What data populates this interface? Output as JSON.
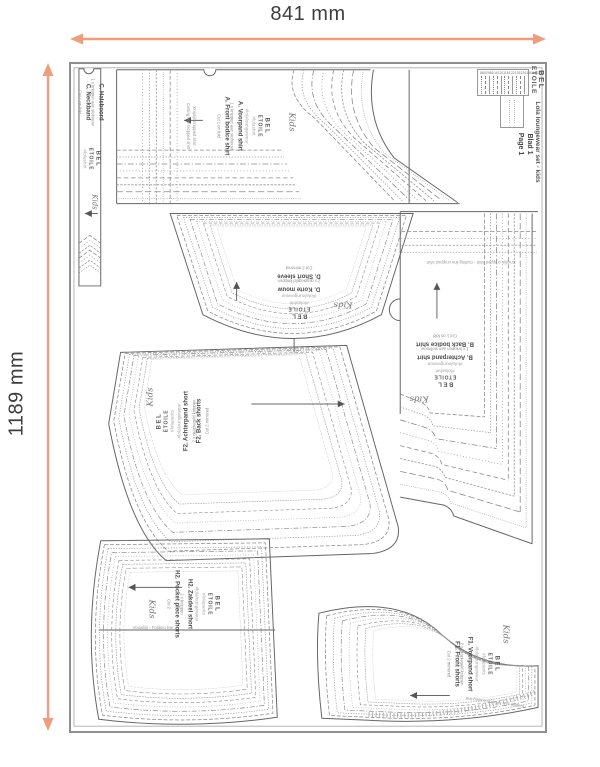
{
  "dimensions": {
    "width_label": "841 mm",
    "height_label": "1189 mm"
  },
  "sheet": {
    "brand_line1": "BEL",
    "brand_line2": "ETOILE",
    "title": "Lola loungewear set - kids",
    "blad": "Blad 1",
    "page": "Page 1",
    "size_legend": {
      "sizes": [
        "86",
        "92",
        "98",
        "104",
        "110",
        "116",
        "122",
        "128",
        "134",
        "140",
        "146",
        "152"
      ]
    }
  },
  "script_logo": "Kids",
  "colors": {
    "accent": "#ef9d7c",
    "line": "#6e6e6e"
  },
  "pieces": {
    "A": {
      "name_nl": "A. Voorpand shirt",
      "cut_nl": "1 x knippen aan stofvouw",
      "name_en": "A. Front bodice shirt",
      "cut_en": "Cut 1 on fold",
      "tag1": "#lolashirt",
      "tag2": "#lolaloungewear",
      "note_nl": "Kniplijn cropped shirt",
      "note_en": "Cutting line cropped shirt"
    },
    "B": {
      "name_nl": "B. Achterpand shirt",
      "cut_nl": "1 x knippen aan stofvouw",
      "name_en": "B. Back bodice shirt",
      "cut_en": "Cut 1 on fold",
      "tag1": "#lolashirt",
      "tag2": "#lolaloungewear",
      "note": "Kniplijn cropped shirt - Cutting line cropped shirt"
    },
    "C": {
      "name_nl": "C. Halsboord",
      "cut_nl": "1 x knippen aan stofvouw",
      "name_en": "C. Neckband",
      "cut_en": "Cut 1 on fold",
      "tag1": "#lolashirt",
      "tag2": "#lolaloungewear"
    },
    "D": {
      "name_nl": "D. Korte mouw",
      "cut_nl": "2 x gespiegeld knippen",
      "name_en": "D. Short sleeve",
      "cut_en": "Cut 2 mirrored",
      "tag1": "#lolashirt",
      "tag2": "#lolaloungewear"
    },
    "F2": {
      "name_nl": "F2. Achterpand short",
      "cut_nl": "2 x gespiegeld knippen",
      "name_en": "F2. Back shorts",
      "cut_en": "Cut 2 mirrored",
      "tag1": "#lolapants",
      "tag2": "#lolaloungewear"
    },
    "H2": {
      "name_nl": "H2. Zakdeel short",
      "cut_nl": "2 x knippen",
      "name_en": "H2. Pocket piece shorts",
      "cut_en": "Cut 2",
      "tag1": "#lolapants",
      "tag2": "#lolaloungewear",
      "fold_line": "Vouwlijn - Folding line"
    },
    "F1": {
      "name_nl": "F1. Voorpand short",
      "cut_nl": "2 x gespiegeld knippen",
      "name_en": "F1. Front shorts",
      "cut_en": "Cut 2 mirrored",
      "tag1": "#lolapants",
      "tag2": "#lolaloungewear",
      "note": "Kniplijn zak - Pocket cutting line"
    }
  }
}
